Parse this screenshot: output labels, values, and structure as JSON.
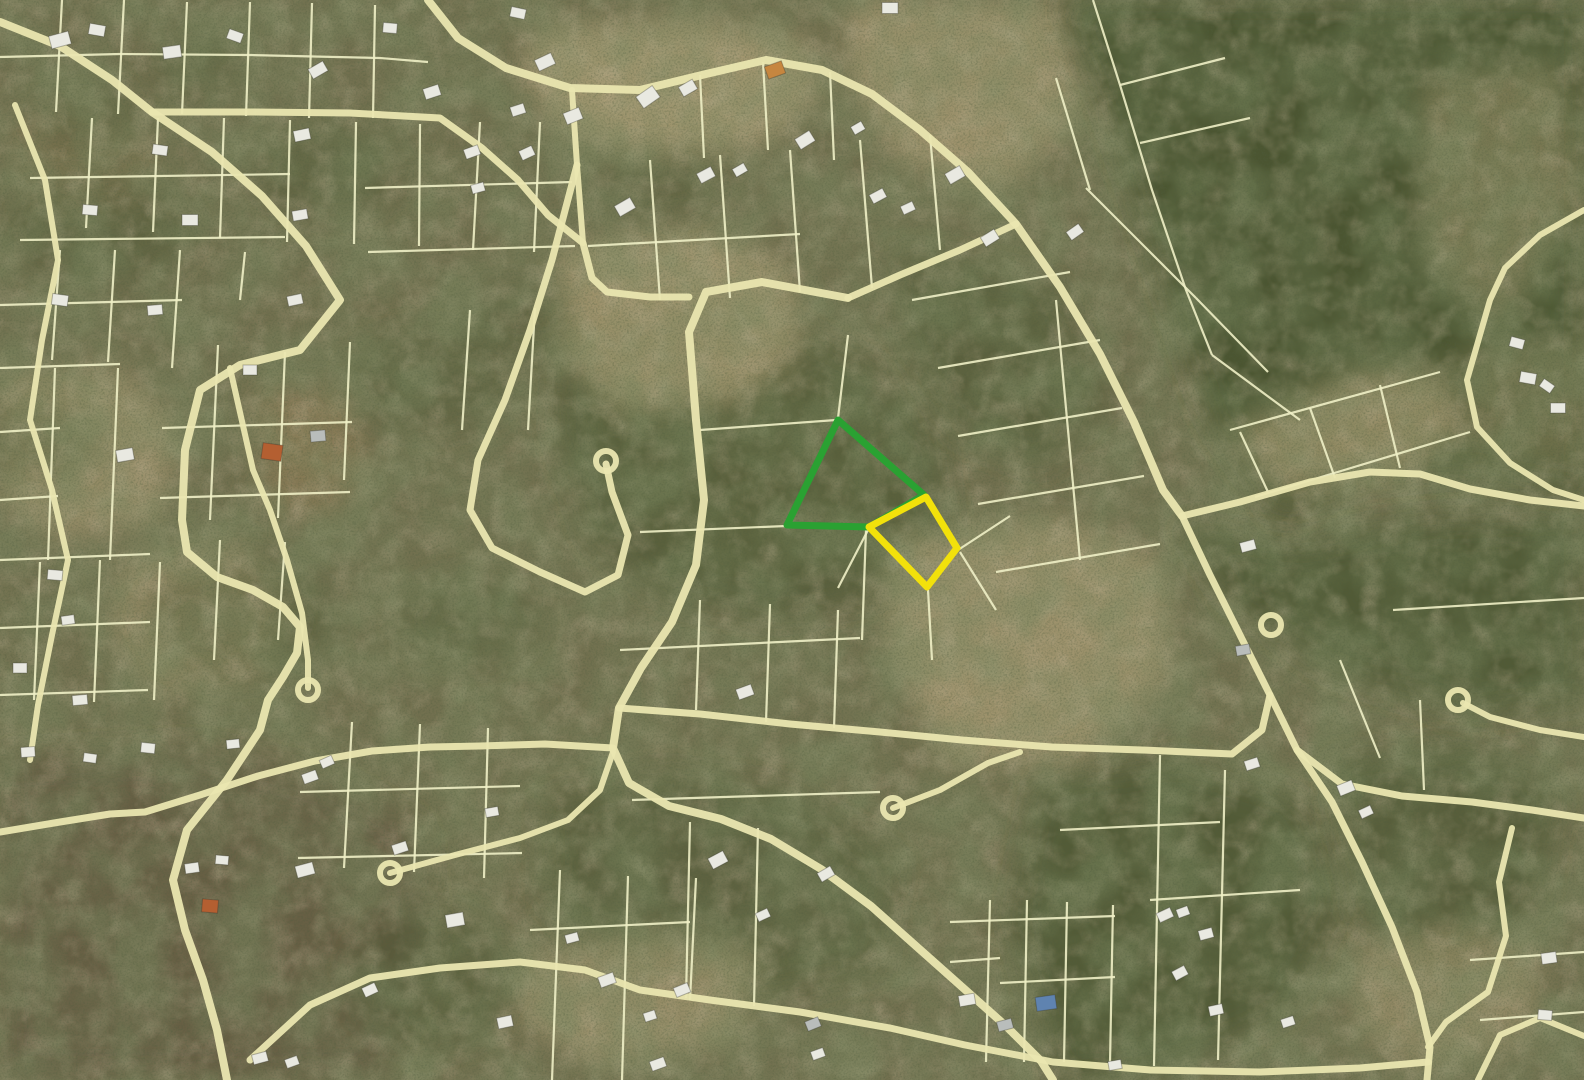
{
  "map": {
    "width": 1584,
    "height": 1080,
    "palette": {
      "base": "#72704f",
      "forest": "#47522e",
      "darkbrown": "#655b43",
      "tan": "#b0a179",
      "brown": "#8b7b57",
      "parcel_line": "#eff0c6",
      "road": "#eae6b0",
      "house_w": "#e9e9e1",
      "house_g": "#b9bdbb",
      "roof_o": "#b45f31",
      "roof_o2": "#c6863f",
      "roof_b": "#5f83b0",
      "highlight_green": "#2aa132",
      "highlight_yellow": "#f2e10b"
    },
    "terrain": {
      "polygons": [
        {
          "p": "1060,0 1584,0 1584,495 1470,470 1360,480 1280,520 1210,420 1150,240 1098,85",
          "f": "forest",
          "o": 0.9
        },
        {
          "p": "1180,525 1300,545 1420,520 1584,515 1584,700 1460,715 1330,670 1230,600",
          "f": "forest",
          "o": 0.75
        },
        {
          "p": "560,330 640,300 720,300 800,330 880,370 940,440 950,540 880,595 780,620 670,600 590,540 555,430",
          "f": "forest",
          "o": 0.55
        },
        {
          "p": "1040,780 1180,760 1300,800 1340,900 1290,1010 1160,1075 1060,1080 1010,920",
          "f": "forest",
          "o": 0.7
        },
        {
          "p": "1330,760 1470,742 1560,790 1540,900 1450,975 1360,920",
          "f": "forest",
          "o": 0.6
        },
        {
          "p": "545,800 660,770 790,790 900,860 880,970 760,1000 620,965 545,900",
          "f": "forest",
          "o": 0.45
        },
        {
          "p": "900,250 1050,280 1110,400 1040,470 950,430 900,330",
          "f": "forest",
          "o": 0.5
        },
        {
          "p": "0,760 200,750 330,780 420,830 430,950 380,1080 0,1080",
          "f": "darkbrown",
          "o": 0.8
        },
        {
          "p": "540,28 700,18 805,40 822,92 770,142 650,162 560,132 520,70",
          "f": "tan",
          "o": 0.8
        },
        {
          "p": "848,0 1052,0 1082,120 1000,192 898,162 848,80",
          "f": "tan",
          "o": 0.7
        },
        {
          "p": "558,248 700,228 792,268 802,350 740,402 620,412 558,350",
          "f": "tan",
          "o": 0.75
        },
        {
          "p": "253,388 352,393 367,470 330,517 263,507",
          "f": "brown",
          "o": 0.8
        },
        {
          "p": "888,538 1062,518 1162,558 1172,680 1080,762 948,762 888,650",
          "f": "tan",
          "o": 0.7
        },
        {
          "p": "520,960 650,930 760,950 740,1040 600,1070 520,1020",
          "f": "tan",
          "o": 0.6
        },
        {
          "p": "1228,432 1358,370 1440,368 1470,430 1400,482 1280,492",
          "f": "tan",
          "o": 0.7
        },
        {
          "p": "1420,80 1560,62 1584,200 1500,330 1424,258",
          "f": "tan",
          "o": 0.45
        },
        {
          "p": "0,378 122,368 182,430 162,520 62,542 0,502",
          "f": "tan",
          "o": 0.6
        },
        {
          "p": "118,558 232,540 292,600 262,680 152,692 108,630",
          "f": "tan",
          "o": 0.5
        },
        {
          "p": "1350,950 1462,922 1540,952 1532,1040 1420,1072 1358,1030",
          "f": "tan",
          "o": 0.5
        },
        {
          "p": "1456,350 1584,340 1584,470 1470,460",
          "f": "tan",
          "o": 0.35
        },
        {
          "p": "0,120 90,100 160,150 140,210 40,220",
          "f": "brown",
          "o": 0.4
        }
      ],
      "ellipses": [
        [
          100,
          230,
          95,
          55,
          "forest",
          0.35
        ],
        [
          330,
          170,
          75,
          45,
          "forest",
          0.35
        ],
        [
          40,
          440,
          60,
          40,
          "forest",
          0.35
        ],
        [
          430,
          380,
          85,
          50,
          "forest",
          0.35
        ],
        [
          240,
          620,
          95,
          60,
          "forest",
          0.35
        ],
        [
          470,
          620,
          70,
          45,
          "forest",
          0.35
        ],
        [
          660,
          180,
          60,
          35,
          "forest",
          0.3
        ],
        [
          200,
          60,
          50,
          30,
          "forest",
          0.3
        ],
        [
          520,
          320,
          60,
          38,
          "forest",
          0.3
        ],
        [
          90,
          120,
          55,
          32,
          "forest",
          0.3
        ],
        [
          430,
          980,
          80,
          70,
          "forest",
          0.4
        ]
      ]
    },
    "parcel_lines": [
      "62,0 56,112",
      "124,0 118,114",
      "187,2 182,114",
      "250,2 246,116",
      "312,3 309,118",
      "375,5 373,118",
      "0,57 120,54 250,55 380,58 428,62",
      "92,118 86,228",
      "158,118 153,232",
      "224,118 220,238",
      "290,120 287,242",
      "356,122 354,244",
      "420,124 419,246",
      "30,178 290,174",
      "20,240 285,237",
      "365,188 572,182",
      "368,252 575,246",
      "480,122 473,250",
      "540,122 534,252",
      "60,250 52,360",
      "115,250 108,362",
      "180,250 172,368",
      "0,305 182,300",
      "0,368 120,364",
      "55,368 48,560",
      "118,368 110,560",
      "218,345 210,520",
      "285,352 278,518",
      "350,342 344,480",
      "162,428 352,422",
      "160,498 350,492",
      "0,432 60,428",
      "0,500 58,496",
      "0,560 150,554",
      "40,562 34,700",
      "100,560 94,702",
      "160,562 154,700",
      "0,628 150,622",
      "0,695 148,690",
      "220,540 214,660",
      "285,542 278,640",
      "352,722 344,868",
      "420,724 414,872",
      "488,728 484,878",
      "300,792 520,786",
      "298,858 522,853",
      "560,870 552,1080",
      "628,876 622,1080",
      "696,878 690,1000",
      "530,930 690,922",
      "650,160 660,300",
      "720,155 730,298",
      "790,150 800,292",
      "860,140 872,288",
      "930,135 940,250",
      "588,246 800,234",
      "700,75 704,158",
      "763,62 768,150",
      "830,72 834,160",
      "912,300 1070,272",
      "938,368 1100,340",
      "958,436 1122,408",
      "978,504 1144,476",
      "996,572 1160,544",
      "1056,300 1080,560",
      "866,530 862,640",
      "928,590 932,660",
      "958,550 1010,516",
      "960,552 996,610",
      "700,430 836,420",
      "838,418 848,335",
      "640,532 786,526",
      "700,600 696,710",
      "770,604 766,722",
      "838,610 834,728",
      "620,650 860,638",
      "690,822 686,998",
      "758,828 754,1006",
      "632,800 880,792",
      "990,900 986,1062",
      "1027,900 1024,1062",
      "1067,902 1064,1062",
      "1113,905 1110,1063",
      "950,922 1115,916",
      "950,962 1000,958",
      "1000,983 1115,977",
      "1225,770 1218,1060",
      "1160,755 1154,1066",
      "1060,830 1220,822",
      "1150,900 1300,890",
      "1470,960 1584,952",
      "1480,1020 1584,1012",
      "1230,430 1440,372",
      "1255,497 1470,432",
      "1240,432 1268,492",
      "1310,408 1335,478",
      "1380,385 1400,468",
      "1393,610 1584,598",
      "1420,700 1424,790",
      "1093,0 1120,85 1152,190 1186,290 1212,355",
      "1056,78 1090,190",
      "1086,188 1196,298",
      "1140,143 1250,118",
      "1120,85 1225,58",
      "1196,298 1268,372",
      "1212,355 1300,420",
      "470,310 462,430",
      "535,308 528,430",
      "1340,660 1380,758",
      "868,530 838,588",
      "245,252 240,300"
    ],
    "roads": {
      "paths": [
        {
          "p": "0,22 60,46 112,80 152,112 212,152 262,196 306,246 340,300 300,350 240,365 200,390 185,450 182,520 187,552 217,577 253,590 283,607 300,627 297,653 283,677 268,700 260,730 227,780 187,830 173,880 185,930 203,980 217,1030 227,1080",
          "w": 8
        },
        {
          "p": "152,112 250,112 350,113 440,118 482,148 518,180 548,215 583,243 592,278 607,292 650,297 689,297",
          "w": 7
        },
        {
          "p": "572,90 577,165 583,243",
          "w": 6
        },
        {
          "p": "428,0 458,38 506,68 570,88 640,90 706,74 766,60 822,70 872,94 920,130 968,172 1016,224 1060,287 1100,354 1134,422 1163,490 1182,516",
          "w": 8
        },
        {
          "p": "1182,516 1240,502 1310,482 1370,472 1420,474 1470,489 1530,500 1584,506",
          "w": 7
        },
        {
          "p": "1182,516 1210,575 1240,635 1270,695 1297,750 1342,784 1402,796 1472,802 1532,810 1584,818",
          "w": 7
        },
        {
          "p": "1297,750 1332,802 1362,862 1392,927 1417,992 1430,1047 1427,1080",
          "w": 7
        },
        {
          "p": "1584,737 1540,730 1490,717 1463,703",
          "w": 6
        },
        {
          "p": "1512,828 1499,882 1506,936 1488,992 1446,1022 1428,1047",
          "w": 6
        },
        {
          "p": "1584,1036 1540,1018 1500,1035 1478,1080",
          "w": 6
        },
        {
          "p": "1016,224 960,250 900,275 848,298",
          "w": 7
        },
        {
          "p": "848,298 762,282 706,292 689,332 696,420 704,500 696,565 672,622 641,668 619,708 613,748 629,783 669,806 721,819 771,839 821,869 871,906 916,946 961,986 1006,1026 1041,1061 1053,1080",
          "w": 8
        },
        {
          "p": "619,708 700,714 790,724 880,732 962,740 1052,747 1142,750 1232,754 1262,730 1270,695",
          "w": 7
        },
        {
          "p": "893,808 940,790 988,763 1020,752",
          "w": 6
        },
        {
          "p": "390,873 455,855 520,838 568,820 600,790 613,752",
          "w": 6
        },
        {
          "p": "15,105 45,180 58,260 42,340 30,420 52,490 68,560 52,635 38,705 30,760",
          "w": 6
        },
        {
          "p": "577,165 552,260 530,330 505,400 478,460 470,510 492,548 540,572 585,592 618,575 628,535 612,492 606,464",
          "w": 7
        },
        {
          "p": "0,832 60,822 110,814 145,812 200,795 258,776 315,761 372,751 430,747 480,746 545,744 613,748",
          "w": 7
        },
        {
          "p": "250,1060 310,1005 370,978 440,968 520,962 585,970 640,990 710,1000 800,1012 890,1028 965,1045 1053,1062 1150,1070 1260,1072 1360,1068 1428,1062",
          "w": 7
        },
        {
          "p": "1584,210 1540,235 1505,268 1490,300 1467,380 1477,427 1510,463 1553,490 1584,500",
          "w": 6
        },
        {
          "p": "230,368 253,470 270,510 287,560 302,613 308,660 308,688",
          "w": 6
        }
      ],
      "culdesacs": [
        [
          606,
          461
        ],
        [
          893,
          808
        ],
        [
          390,
          873
        ],
        [
          308,
          690
        ],
        [
          1271,
          625
        ],
        [
          1458,
          700
        ]
      ]
    },
    "houses": [
      [
        60,
        40,
        20,
        13,
        -15,
        "w"
      ],
      [
        97,
        30,
        16,
        11,
        10,
        "w"
      ],
      [
        172,
        52,
        18,
        12,
        -8,
        "w"
      ],
      [
        235,
        36,
        15,
        10,
        20,
        "w"
      ],
      [
        318,
        70,
        17,
        11,
        -30,
        "w"
      ],
      [
        390,
        28,
        14,
        10,
        5,
        "w"
      ],
      [
        432,
        92,
        16,
        11,
        -18,
        "w"
      ],
      [
        518,
        13,
        15,
        10,
        12,
        "w"
      ],
      [
        545,
        62,
        18,
        12,
        -25,
        "w"
      ],
      [
        648,
        97,
        20,
        14,
        -35,
        "w"
      ],
      [
        688,
        88,
        16,
        11,
        -30,
        "w"
      ],
      [
        775,
        70,
        18,
        13,
        -20,
        "o2"
      ],
      [
        890,
        8,
        16,
        11,
        0,
        "w"
      ],
      [
        878,
        196,
        15,
        10,
        -28,
        "w"
      ],
      [
        908,
        208,
        13,
        9,
        -25,
        "w"
      ],
      [
        955,
        175,
        17,
        12,
        -30,
        "w"
      ],
      [
        990,
        238,
        16,
        11,
        -32,
        "w"
      ],
      [
        1075,
        232,
        15,
        10,
        -35,
        "w"
      ],
      [
        1517,
        343,
        14,
        10,
        15,
        "w"
      ],
      [
        1528,
        378,
        16,
        11,
        10,
        "w"
      ],
      [
        1547,
        386,
        13,
        9,
        35,
        "w"
      ],
      [
        1558,
        408,
        15,
        10,
        0,
        "w"
      ],
      [
        160,
        150,
        15,
        10,
        8,
        "w"
      ],
      [
        302,
        135,
        16,
        11,
        -12,
        "w"
      ],
      [
        472,
        152,
        15,
        10,
        -20,
        "w"
      ],
      [
        527,
        153,
        14,
        10,
        -25,
        "w"
      ],
      [
        478,
        188,
        13,
        9,
        -15,
        "w"
      ],
      [
        625,
        207,
        18,
        12,
        -30,
        "w"
      ],
      [
        706,
        175,
        16,
        11,
        -28,
        "w"
      ],
      [
        740,
        170,
        13,
        9,
        -30,
        "w"
      ],
      [
        805,
        140,
        17,
        12,
        -32,
        "w"
      ],
      [
        858,
        128,
        12,
        9,
        -30,
        "w"
      ],
      [
        573,
        116,
        17,
        12,
        -22,
        "w"
      ],
      [
        518,
        110,
        14,
        10,
        -18,
        "w"
      ],
      [
        90,
        210,
        15,
        10,
        5,
        "w"
      ],
      [
        190,
        220,
        16,
        11,
        0,
        "w"
      ],
      [
        300,
        215,
        15,
        10,
        -10,
        "w"
      ],
      [
        60,
        300,
        16,
        11,
        8,
        "w"
      ],
      [
        155,
        310,
        15,
        10,
        -5,
        "w"
      ],
      [
        295,
        300,
        15,
        10,
        -12,
        "w"
      ],
      [
        250,
        370,
        14,
        10,
        0,
        "w"
      ],
      [
        125,
        455,
        17,
        12,
        -10,
        "w"
      ],
      [
        318,
        436,
        15,
        11,
        -5,
        "g"
      ],
      [
        272,
        452,
        20,
        16,
        8,
        "o"
      ],
      [
        55,
        575,
        15,
        10,
        5,
        "w"
      ],
      [
        68,
        620,
        13,
        9,
        -8,
        "w"
      ],
      [
        20,
        668,
        14,
        10,
        0,
        "w"
      ],
      [
        80,
        700,
        15,
        10,
        -5,
        "w"
      ],
      [
        148,
        748,
        14,
        10,
        6,
        "w"
      ],
      [
        28,
        752,
        14,
        10,
        -4,
        "w"
      ],
      [
        90,
        758,
        13,
        9,
        8,
        "w"
      ],
      [
        233,
        744,
        13,
        9,
        -6,
        "w"
      ],
      [
        310,
        777,
        15,
        10,
        -20,
        "w"
      ],
      [
        327,
        762,
        13,
        9,
        -24,
        "w"
      ],
      [
        305,
        870,
        18,
        12,
        -15,
        "w"
      ],
      [
        222,
        860,
        13,
        9,
        5,
        "w"
      ],
      [
        192,
        868,
        14,
        10,
        -8,
        "w"
      ],
      [
        210,
        906,
        16,
        13,
        5,
        "o"
      ],
      [
        400,
        848,
        15,
        10,
        -18,
        "w"
      ],
      [
        370,
        990,
        14,
        10,
        -25,
        "w"
      ],
      [
        260,
        1058,
        15,
        10,
        -15,
        "w"
      ],
      [
        292,
        1062,
        13,
        9,
        -20,
        "w"
      ],
      [
        745,
        692,
        16,
        11,
        -20,
        "w"
      ],
      [
        718,
        860,
        17,
        12,
        -28,
        "w"
      ],
      [
        826,
        874,
        15,
        10,
        -30,
        "w"
      ],
      [
        607,
        980,
        16,
        11,
        -20,
        "w"
      ],
      [
        682,
        990,
        15,
        10,
        -22,
        "w"
      ],
      [
        650,
        1016,
        12,
        9,
        -18,
        "w"
      ],
      [
        658,
        1064,
        15,
        10,
        -20,
        "w"
      ],
      [
        455,
        920,
        18,
        13,
        -10,
        "w"
      ],
      [
        505,
        1022,
        15,
        11,
        -12,
        "w"
      ],
      [
        492,
        812,
        13,
        9,
        -10,
        "w"
      ],
      [
        572,
        938,
        13,
        9,
        -15,
        "w"
      ],
      [
        813,
        1024,
        14,
        10,
        -22,
        "g"
      ],
      [
        818,
        1054,
        13,
        9,
        -20,
        "w"
      ],
      [
        763,
        915,
        13,
        9,
        -25,
        "w"
      ],
      [
        967,
        1000,
        16,
        11,
        -10,
        "w"
      ],
      [
        1005,
        1025,
        15,
        10,
        -15,
        "g"
      ],
      [
        1046,
        1003,
        20,
        14,
        -8,
        "b"
      ],
      [
        1165,
        915,
        15,
        10,
        -25,
        "w"
      ],
      [
        1183,
        912,
        12,
        9,
        -20,
        "w"
      ],
      [
        1180,
        973,
        14,
        10,
        -28,
        "w"
      ],
      [
        1248,
        546,
        15,
        10,
        -15,
        "w"
      ],
      [
        1243,
        650,
        14,
        10,
        -10,
        "g"
      ],
      [
        1252,
        764,
        14,
        10,
        -18,
        "w"
      ],
      [
        1346,
        788,
        16,
        11,
        -22,
        "w"
      ],
      [
        1366,
        812,
        13,
        9,
        -25,
        "w"
      ],
      [
        1206,
        934,
        14,
        10,
        -15,
        "w"
      ],
      [
        1216,
        1010,
        14,
        10,
        -12,
        "w"
      ],
      [
        1288,
        1022,
        13,
        9,
        -18,
        "w"
      ],
      [
        1549,
        958,
        15,
        11,
        -8,
        "w"
      ],
      [
        1545,
        1015,
        14,
        10,
        5,
        "w"
      ],
      [
        1115,
        1065,
        13,
        9,
        -10,
        "w"
      ]
    ],
    "highlights": [
      {
        "name": "highlighted-parcel-green",
        "points": "838,420 924,495 869,527 787,525",
        "color_key": "highlight_green",
        "stroke_width": 7
      },
      {
        "name": "highlighted-parcel-yellow",
        "points": "926,497 957,548 927,587 869,527",
        "color_key": "highlight_yellow",
        "stroke_width": 7
      }
    ]
  }
}
